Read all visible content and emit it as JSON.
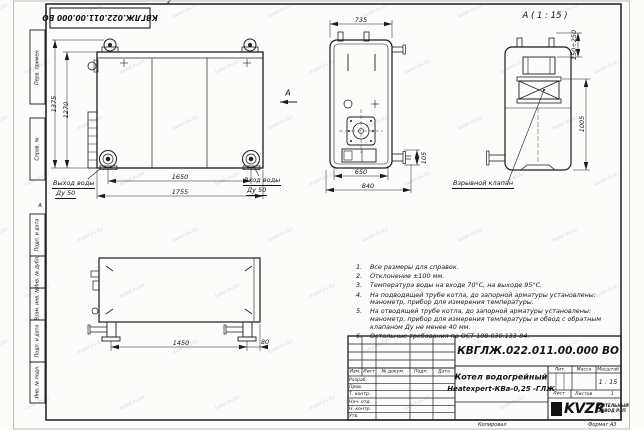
{
  "sheet": {
    "stamp_top_rotated": "КВГЛЖ.022.011.00.000 ВО",
    "zone_top": "2",
    "zone_left": "А",
    "left_margin_fields": [
      "Перв. примен.",
      "Справ. №",
      "Подп. и дата",
      "Инв. № дубл.",
      "Взам. инв. №",
      "Подп. и дата",
      "Инв. № подл."
    ],
    "footer": {
      "copied": "Копировал",
      "format": "Формат А3"
    },
    "watermark": "kotel-kv.kz"
  },
  "views": {
    "front": {
      "dim_height_overall": "1375",
      "dim_height_body": "1270",
      "dim_width_fittings": "1650",
      "dim_width_overall": "1755",
      "outlet_title": "Выход воды",
      "outlet_dn": "Ду 50",
      "inlet_title": "Вход воды",
      "inlet_dn": "Ду 50",
      "section_arrow_label": "А"
    },
    "top": {
      "dim_width_top": "735",
      "dim_width_inner": "650",
      "dim_width_overall": "840",
      "dim_flange_offset": "105"
    },
    "detail": {
      "title": "А ( 1 : 15 )",
      "dim_valve_travel": "150÷250",
      "dim_height": "1005",
      "callout_explosion_valve": "Взрывной клапан"
    },
    "side": {
      "dim_legs_span": "1450",
      "dim_leg_offset": "80"
    }
  },
  "notes": {
    "items": [
      {
        "num": "1.",
        "text": "Все размеры для справок."
      },
      {
        "num": "2.",
        "text": "Отклонение ±100 мм."
      },
      {
        "num": "3.",
        "text": "Температура воды на входе 70°С, на выходе 95°С."
      },
      {
        "num": "4.",
        "text": "На подводящей трубе котла, до запорной арматуры установлены: манометр, прибор для измерения температуры."
      },
      {
        "num": "5.",
        "text": "На отводящей трубе котла, до запорной арматуры установлены: манометр, прибор для измерения температуры и обвод с обратным клапаном Ду не менее 40 мм."
      },
      {
        "num": "6.",
        "text": "Остальные требования по ОСТ 108.030.133-84."
      }
    ]
  },
  "title_block": {
    "doc_number": "КВГЛЖ.022.011.00.000 ВО",
    "product_name_line1": "Котел водогрейный",
    "product_name_line2": "Heatexpert-КВа-0,25 -ГЛЖ",
    "header_cols": [
      "Изм.",
      "Лист",
      "№ докум.",
      "Подп.",
      "Дата"
    ],
    "signature_rows": [
      "Разраб.",
      "Пров.",
      "Т. контр.",
      "Нач. отд.",
      "Н. контр.",
      "Утв."
    ],
    "lit_label": "Лит.",
    "mass_label": "Масса",
    "scale_label": "Масштаб",
    "scale_value": "1 : 15",
    "sheet_label": "Лист",
    "sheets_label": "Листов",
    "sheets_value": "1",
    "company_logo": "KVZR",
    "company_name_line1": "КОТЕЛЬНЫЙ",
    "company_name_line2": "ЗАВОД РЭП"
  }
}
